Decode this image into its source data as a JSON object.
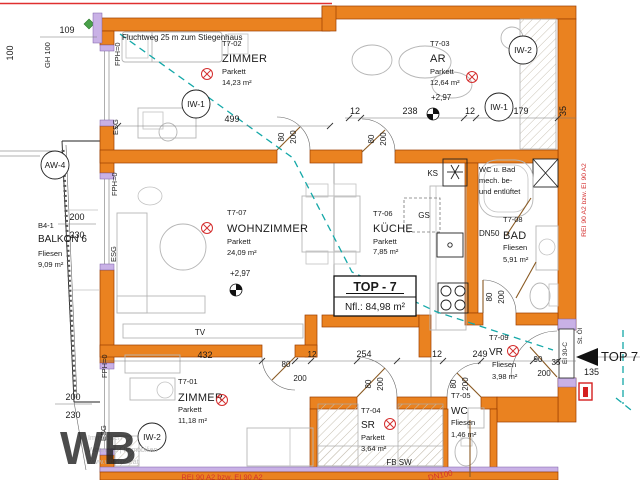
{
  "header": {
    "escape_route": "Fluchtweg 25 m zum Stiegenhaus"
  },
  "unit": {
    "title": "TOP - 7",
    "net_area": "Nfl.: 84,98 m²",
    "entrance_label": "TOP 7",
    "entrance_number": "135",
    "door_class": "EI 30-C",
    "note_st_oel": "St. Öl"
  },
  "fire": {
    "right_wall": "REI 90 A2 bzw. EI 90 A2",
    "bottom_wall": "REI 90 A2 bzw. EI 90 A2",
    "dn50": "DN50",
    "dn100": "DN100"
  },
  "rooms": {
    "zimmer1": {
      "id": "T7-01",
      "name": "ZIMMER",
      "floor": "Parkett",
      "area": "11,18 m²"
    },
    "zimmer2": {
      "id": "T7-02",
      "name": "ZIMMER",
      "floor": "Parkett",
      "area": "14,23 m²"
    },
    "ar": {
      "id": "T7-03",
      "name": "AR",
      "floor": "Parkett",
      "area": "12,64 m²",
      "level": "+2,97"
    },
    "sr": {
      "id": "T7-04",
      "name": "SR",
      "floor": "Parkett",
      "area": "3,64 m²"
    },
    "wc": {
      "id": "T7-05",
      "name": "WC",
      "floor": "Fliesen",
      "area": "1,46 m²"
    },
    "kueche": {
      "id": "T7-06",
      "name": "KÜCHE",
      "floor": "Parkett",
      "area": "7,85 m²"
    },
    "wohnzimmer": {
      "id": "T7-07",
      "name": "WOHNZIMMER",
      "floor": "Parkett",
      "area": "24,09 m²",
      "level": "+2,97"
    },
    "bad": {
      "id": "T7-08",
      "name": "BAD",
      "floor": "Fliesen",
      "area": "5,91 m²"
    },
    "vr": {
      "id": "T7-09",
      "name": "VR",
      "floor": "Fliesen",
      "area": "3,98 m²"
    },
    "balkon": {
      "id": "B4-1",
      "name": "BALKON 6",
      "floor": "Fliesen",
      "area": "9,09 m²"
    }
  },
  "labels": {
    "ks": "KS",
    "gs": "GS",
    "tv": "TV",
    "fb_sw": "FB SW",
    "vent_line1": "WC u. Bad",
    "vent_line2": "mech. be-",
    "vent_line3": "und entlüftet",
    "esg": "ESG",
    "fph": "FPH=0",
    "gh100": "GH 100"
  },
  "markers": {
    "iw1": "IW-1",
    "iw2": "IW-2",
    "aw4": "AW-4"
  },
  "dims": {
    "d100": "100",
    "d109": "109",
    "d200": "200",
    "d230": "230",
    "d499": "499",
    "d12": "12",
    "d238": "238",
    "d179": "179",
    "d35": "35",
    "d80": "80",
    "d432": "432",
    "d254": "254",
    "d249": "249",
    "d90": "90"
  },
  "watermark": {
    "logo": "WB",
    "line1": "Immobilien",
    "line2": "Wohnbau | Immobilien",
    "line3": "www.wbimmo.at"
  },
  "colors": {
    "wall": "#ea8220",
    "window_band": "#c9b1e6",
    "escape": "#14a8a8",
    "fire_text": "#d43030"
  }
}
